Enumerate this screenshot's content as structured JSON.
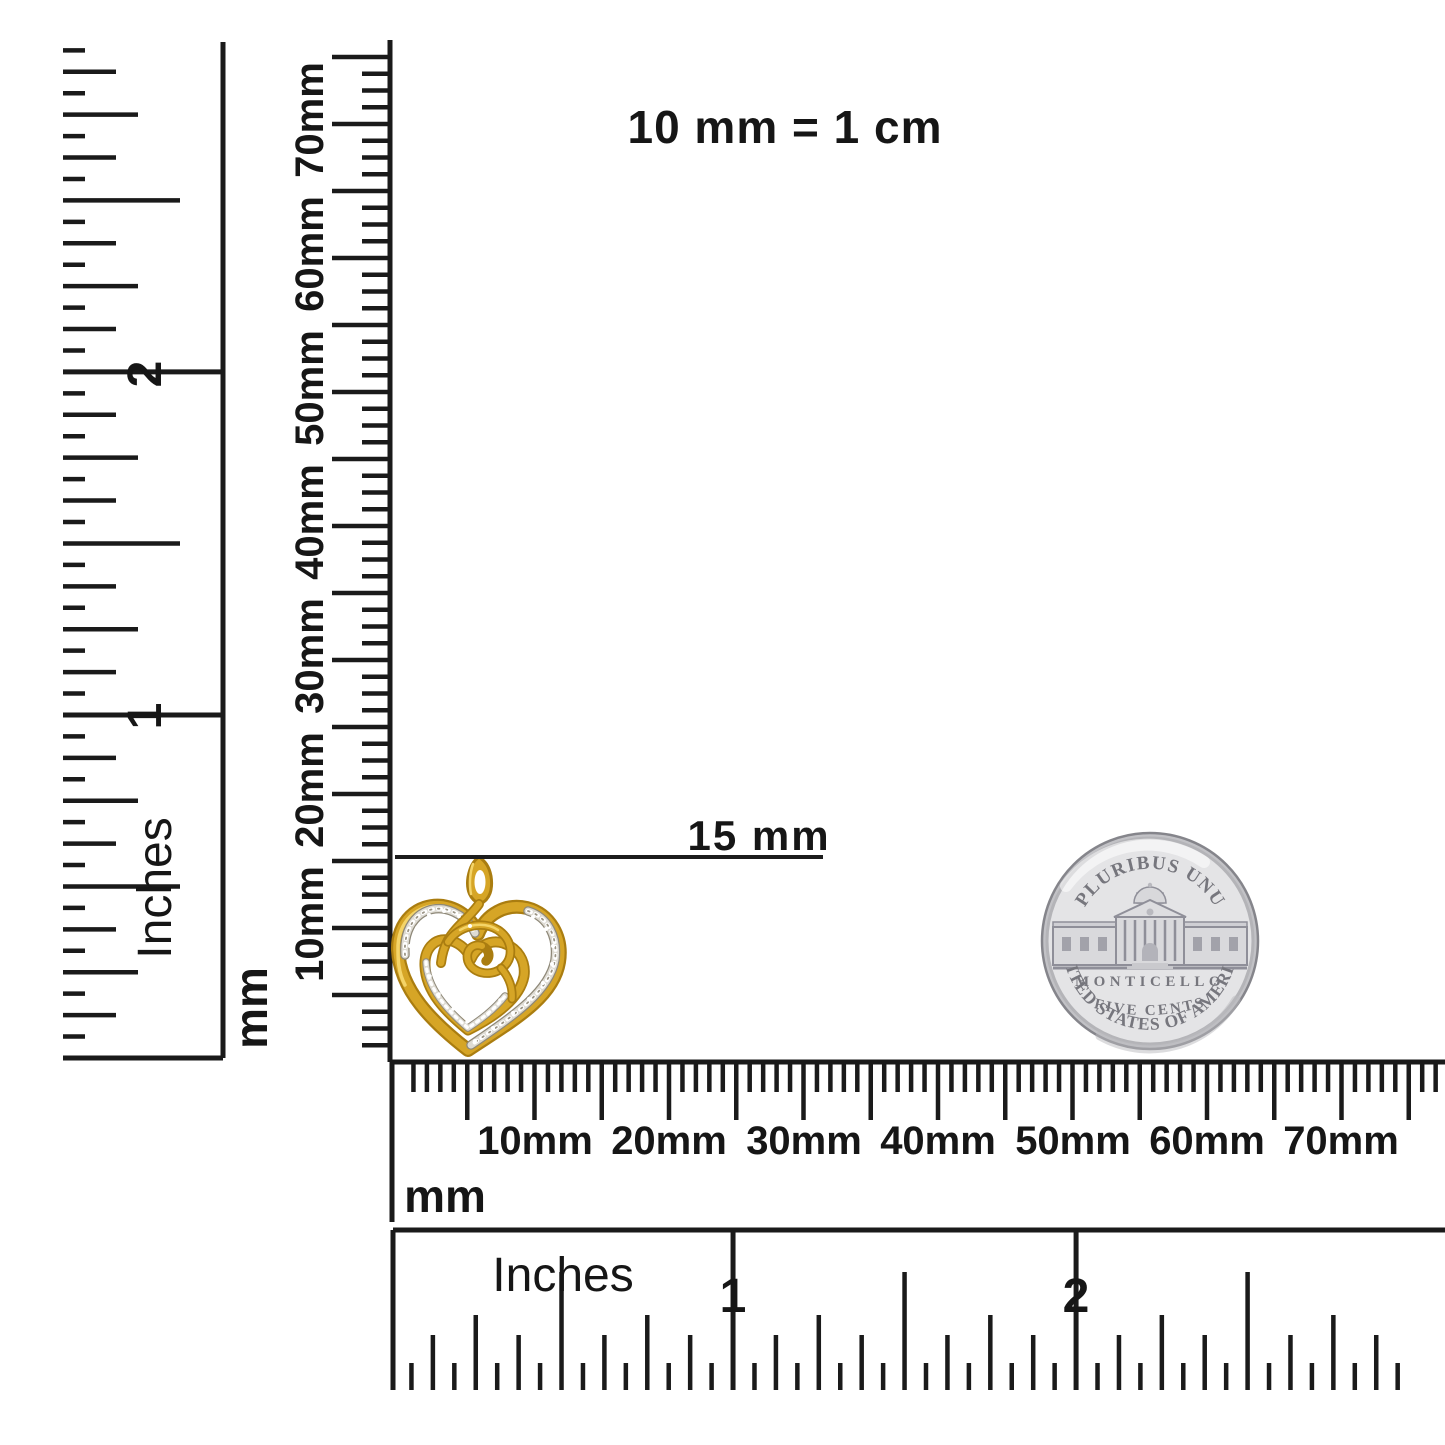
{
  "title": {
    "text": "10 mm = 1 cm"
  },
  "annotation": {
    "text": "15 mm"
  },
  "rulers": {
    "left_inches": {
      "unit_label": "Inches",
      "numerals": [
        "1",
        "2"
      ]
    },
    "vertical_mm": {
      "unit_label": "mm",
      "tick_labels": [
        "10mm",
        "20mm",
        "30mm",
        "40mm",
        "50mm",
        "60mm",
        "70mm"
      ]
    },
    "horizontal_mm": {
      "unit_label": "mm",
      "tick_labels": [
        "10mm",
        "20mm",
        "30mm",
        "40mm",
        "50mm",
        "60mm",
        "70mm"
      ]
    },
    "bottom_inches": {
      "unit_label": "Inches",
      "numerals": [
        "1",
        "2"
      ]
    }
  },
  "coin": {
    "legend_top": "E PLURIBUS UNUM",
    "building_label": "MONTICELLO",
    "denomination": "FIVE CENTS",
    "legend_bottom": "UNITED STATES OF AMERICA",
    "colors": {
      "face": "#e4e4e6",
      "rim": "#8a8a90",
      "text": "#76767d"
    }
  },
  "pendant": {
    "colors": {
      "gold": "#d6a526",
      "gold_light": "#f4d468",
      "gold_dark": "#aa7d10",
      "pave": "#dedbd3"
    }
  },
  "ink": "#1a1a1a"
}
